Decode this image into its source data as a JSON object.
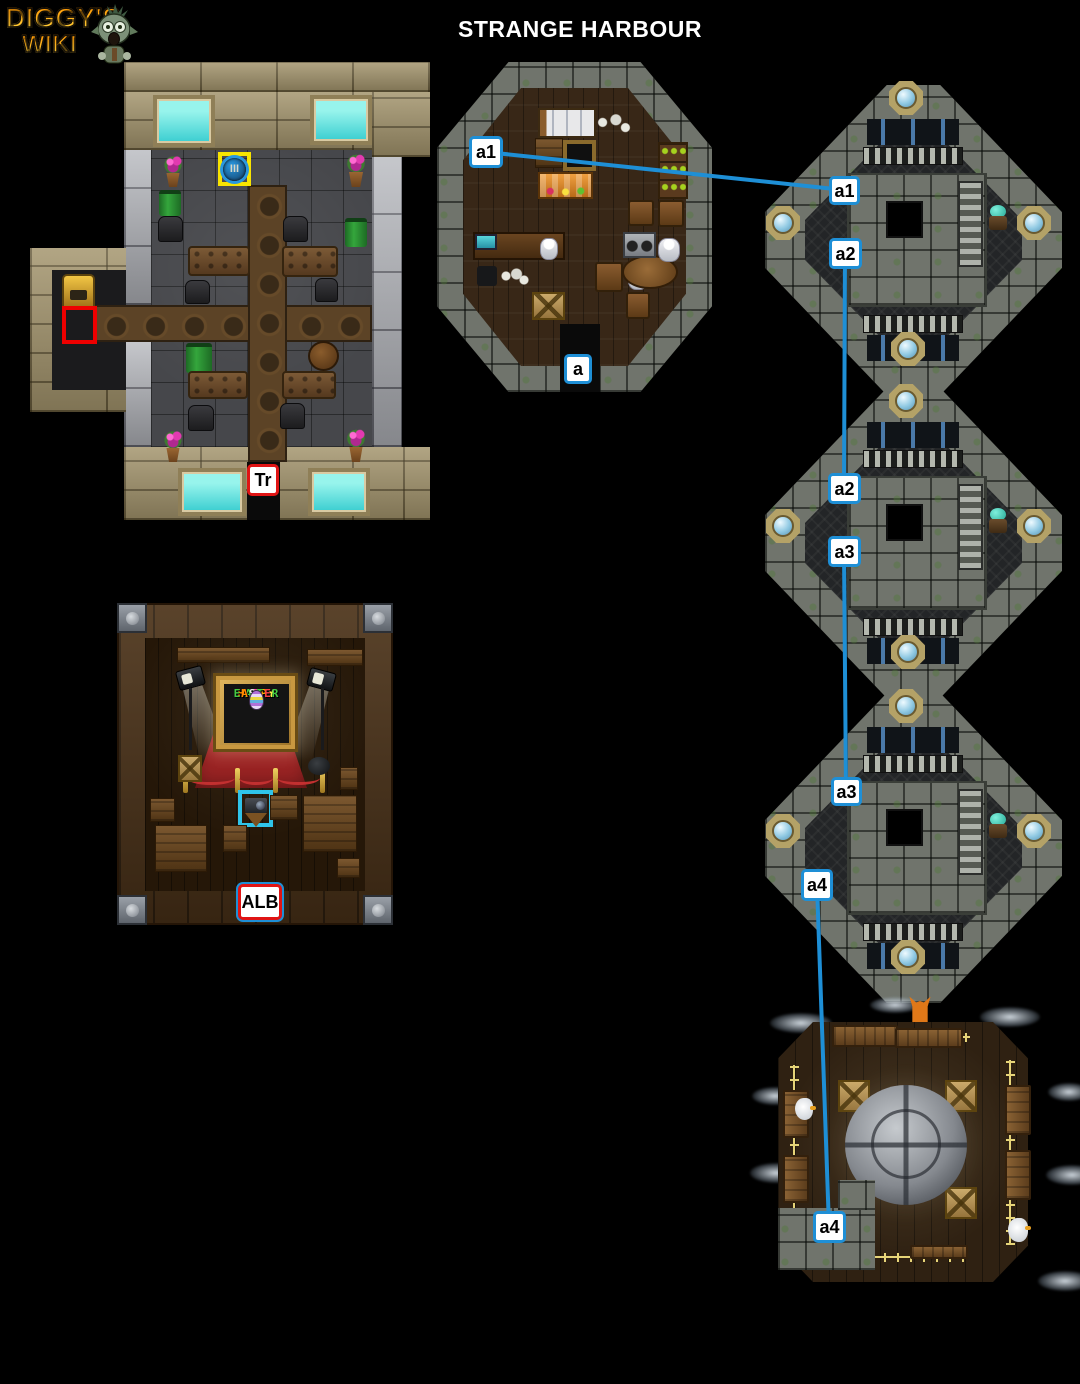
{
  "site": {
    "logo_line1": "DIGGY'S",
    "logo_line2": "WIKI",
    "mascot": "diggy-mascot"
  },
  "title": "STRANGE HARBOUR",
  "colors": {
    "background": "#000000",
    "connector_blue": "#1e8fd6",
    "label_border_blue": "#1e8fd6",
    "label_border_red": "#e01414",
    "highlight_yellow": "#f8e400",
    "highlight_red": "#ee0000",
    "highlight_cyan": "#2fc4ea",
    "logo_orange": "#ff9400",
    "title_white": "#ffffff"
  },
  "portal_labels": [
    {
      "text": "a1",
      "style": "blue",
      "x": 469,
      "y": 136,
      "w": 34,
      "h": 32
    },
    {
      "text": "a",
      "style": "blue",
      "x": 564,
      "y": 354,
      "w": 28,
      "h": 30
    },
    {
      "text": "a1",
      "style": "blue",
      "x": 829,
      "y": 176,
      "w": 31,
      "h": 29
    },
    {
      "text": "a2",
      "style": "blue",
      "x": 829,
      "y": 238,
      "w": 33,
      "h": 31
    },
    {
      "text": "a2",
      "style": "blue",
      "x": 828,
      "y": 473,
      "w": 33,
      "h": 31
    },
    {
      "text": "a3",
      "style": "blue",
      "x": 828,
      "y": 536,
      "w": 33,
      "h": 31
    },
    {
      "text": "a3",
      "style": "blue",
      "x": 831,
      "y": 777,
      "w": 31,
      "h": 29
    },
    {
      "text": "a4",
      "style": "blue",
      "x": 801,
      "y": 869,
      "w": 32,
      "h": 32
    },
    {
      "text": "a4",
      "style": "blue",
      "x": 813,
      "y": 1211,
      "w": 33,
      "h": 32
    },
    {
      "text": "Tr",
      "style": "red",
      "x": 247,
      "y": 464,
      "w": 32,
      "h": 32
    },
    {
      "text": "ALB",
      "style": "red-blue",
      "x": 238,
      "y": 884,
      "w": 44,
      "h": 36
    }
  ],
  "connections": [
    {
      "from": "a1",
      "to": "a1",
      "x1": 486,
      "y1": 152,
      "x2": 844,
      "y2": 190
    },
    {
      "from": "a2",
      "to": "a2",
      "x1": 845,
      "y1": 253,
      "x2": 844,
      "y2": 488
    },
    {
      "from": "a3",
      "to": "a3",
      "x1": 844,
      "y1": 551,
      "x2": 846,
      "y2": 791
    },
    {
      "from": "a4",
      "to": "a4",
      "x1": 817,
      "y1": 885,
      "x2": 829,
      "y2": 1227
    }
  ],
  "coins": [
    {
      "name": "red-coin",
      "glyph": "2",
      "ring": "#e03818",
      "face": "#8a2008",
      "text": "#e8c090"
    },
    {
      "name": "orange-coin",
      "glyph": "F",
      "ring": "#ffa818",
      "face": "#a05c10",
      "text": "#e8d0a0"
    },
    {
      "name": "blue-coin",
      "glyph": "III",
      "ring": "#2898e0",
      "face": "#1a5888",
      "text": "#d8d8c8"
    }
  ],
  "gallery_picture": {
    "line1": [
      {
        "ch": "H",
        "color": "#ff8a00"
      },
      {
        "ch": "A",
        "color": "#44cc44"
      },
      {
        "ch": "P",
        "color": "#ff44aa"
      },
      {
        "ch": "P",
        "color": "#ffaa00"
      },
      {
        "ch": "Y",
        "color": "#ffee44"
      }
    ],
    "line2": [
      {
        "ch": "E",
        "color": "#44cc44"
      },
      {
        "ch": "A",
        "color": "#ff8a00"
      },
      {
        "ch": "S",
        "color": "#eeeeee"
      },
      {
        "ch": "T",
        "color": "#44cc44"
      },
      {
        "ch": "E",
        "color": "#ff4444"
      },
      {
        "ch": "R",
        "color": "#44cc44"
      }
    ]
  },
  "maps": [
    {
      "id": "office-room",
      "note": "metal room with cyan windows, coins highlighted in yellow, idol highlighted in red, exit Tr"
    },
    {
      "id": "tavern-room",
      "note": "stone tavern with exits a and a1"
    },
    {
      "id": "puzzle-room-1",
      "note": "stone puzzle room, portals a1 / a2"
    },
    {
      "id": "puzzle-room-2",
      "note": "stone puzzle room, portals a2 / a3"
    },
    {
      "id": "puzzle-room-3",
      "note": "stone puzzle room, portals a3 / a4"
    },
    {
      "id": "ship-deck",
      "note": "ship deck with dome hatch, portal a4"
    },
    {
      "id": "gallery-room",
      "note": "Happy Easter gallery, camera highlighted in cyan, exit ALB"
    }
  ]
}
